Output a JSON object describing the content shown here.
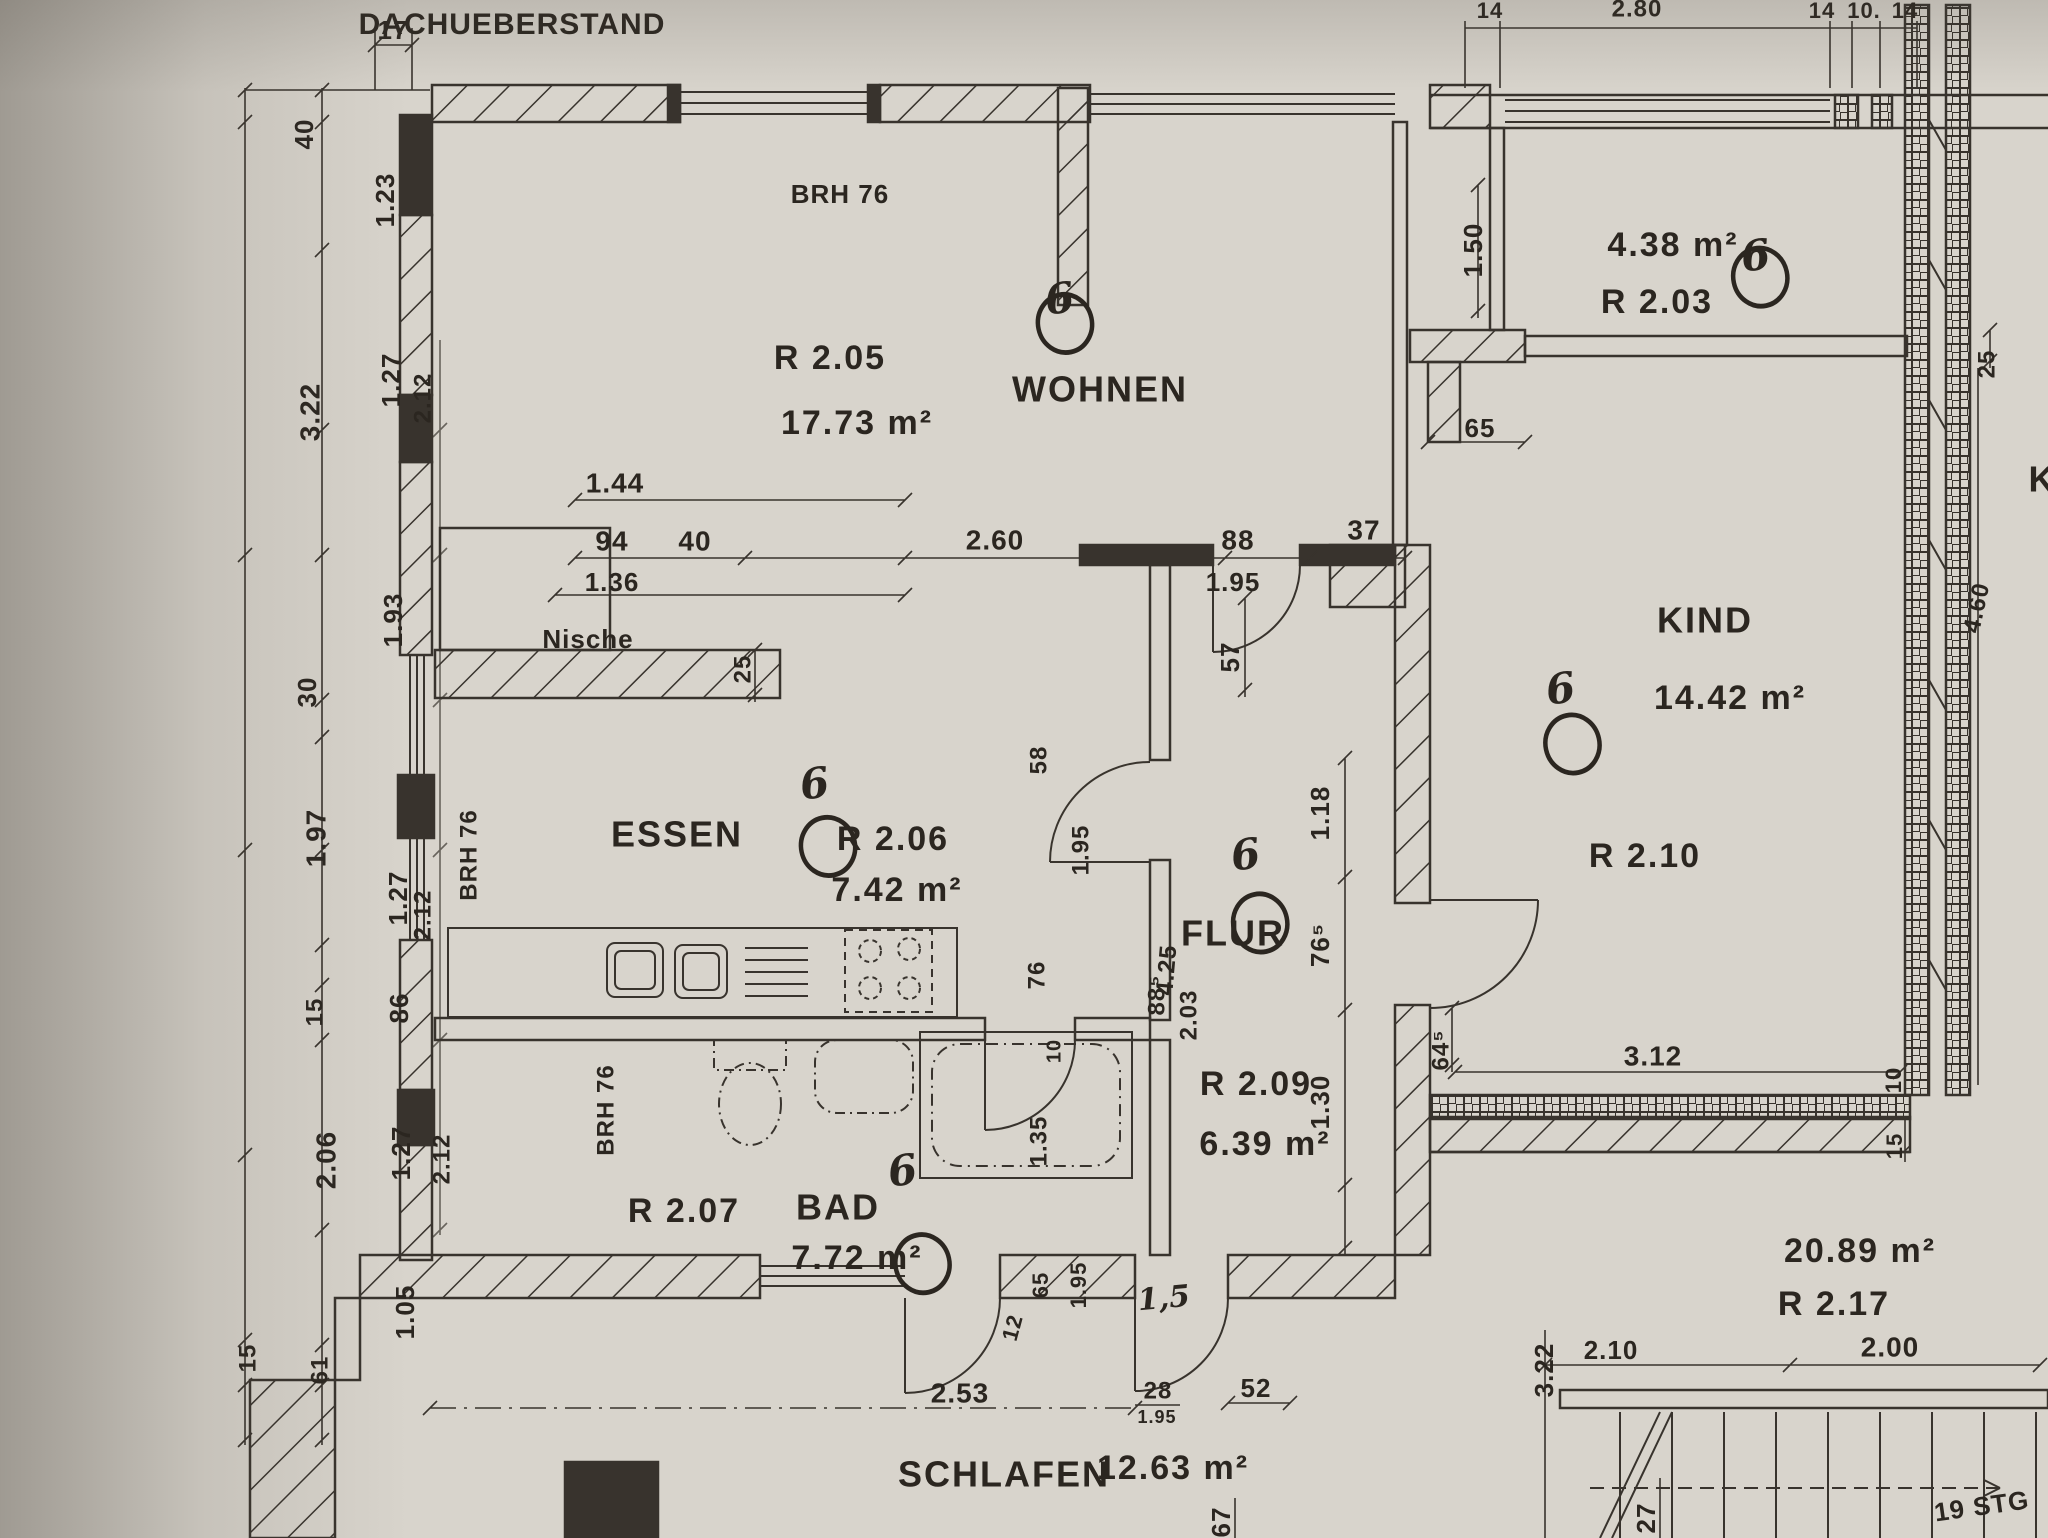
{
  "drawing": {
    "type": "architectural floor plan (photocopy/photo)",
    "note_top": "DACHUEBERSTAND",
    "room_mark_glyph": "6",
    "stair_label": "19 STG"
  },
  "colors": {
    "paper": "#d8d4cc",
    "ink": "#2b2620",
    "shadow": "#4a443c"
  },
  "rooms": [
    {
      "name": "WOHNEN",
      "number": "R 2.05",
      "area": "17.73 m²",
      "nx": 1100,
      "ny": 392,
      "ux": 830,
      "uy": 360,
      "ax": 857,
      "ay": 425,
      "mx": 1060,
      "my": 300
    },
    {
      "name": "ESSEN",
      "number": "R 2.06",
      "area": "7.42 m²",
      "nx": 677,
      "ny": 837,
      "ux": 893,
      "uy": 841,
      "ax": 897,
      "ay": 892,
      "mx": 815,
      "my": 785
    },
    {
      "name": "BAD",
      "number": "R 2.07",
      "area": "7.72 m²",
      "nx": 838,
      "ny": 1210,
      "ux": 684,
      "uy": 1213,
      "ax": 857,
      "ay": 1260,
      "mx": 903,
      "my": 1172
    },
    {
      "name": "FLUR",
      "number": "R 2.09",
      "area": "6.39 m²",
      "nx": 1233,
      "ny": 936,
      "ux": 1256,
      "uy": 1086,
      "ax": 1265,
      "ay": 1146,
      "mx": 1246,
      "my": 856
    },
    {
      "name": "KIND",
      "number": "R 2.10",
      "area": "14.42 m²",
      "nx": 1705,
      "ny": 623,
      "ux": 1645,
      "uy": 858,
      "ax": 1730,
      "ay": 700,
      "mx": 1561,
      "my": 690
    },
    {
      "name": "",
      "number": "R 2.03",
      "area": "4.38 m²",
      "ux": 1657,
      "uy": 304,
      "ax": 1673,
      "ay": 247,
      "mx": 1756,
      "my": 257
    },
    {
      "name": "SCHLAFEN",
      "number": "",
      "area": "12.63 m²",
      "nx": 1004,
      "ny": 1477,
      "ax": 1173,
      "ay": 1470
    },
    {
      "name": "",
      "number": "R 2.17",
      "area": "20.89 m²",
      "ux": 1834,
      "uy": 1306,
      "ax": 1860,
      "ay": 1253
    }
  ],
  "labels": [
    {
      "t": "17",
      "x": 393,
      "y": 32,
      "r": 0,
      "s": 26,
      "k": "d"
    },
    {
      "t": "DACHUEBERSTAND",
      "x": 512,
      "y": 26,
      "r": 0,
      "s": 30,
      "k": "d"
    },
    {
      "t": "BRH 76",
      "x": 840,
      "y": 196,
      "r": 0,
      "s": 26,
      "k": "d"
    },
    {
      "t": "1.44",
      "x": 615,
      "y": 485,
      "r": 0,
      "s": 28,
      "k": "d"
    },
    {
      "t": "94",
      "x": 612,
      "y": 543,
      "r": 0,
      "s": 28,
      "k": "d"
    },
    {
      "t": "40",
      "x": 695,
      "y": 543,
      "r": 0,
      "s": 28,
      "k": "d"
    },
    {
      "t": "1.36",
      "x": 612,
      "y": 584,
      "r": 0,
      "s": 26,
      "k": "d"
    },
    {
      "t": "2.60",
      "x": 995,
      "y": 542,
      "r": 0,
      "s": 28,
      "k": "d"
    },
    {
      "t": "88",
      "x": 1238,
      "y": 542,
      "r": 0,
      "s": 28,
      "k": "d"
    },
    {
      "t": "37",
      "x": 1364,
      "y": 532,
      "r": 0,
      "s": 28,
      "k": "d"
    },
    {
      "t": "1.95",
      "x": 1233,
      "y": 584,
      "r": 0,
      "s": 26,
      "k": "d"
    },
    {
      "t": "57",
      "x": 1232,
      "y": 657,
      "r": -90,
      "s": 26,
      "k": "d"
    },
    {
      "t": "25",
      "x": 744,
      "y": 669,
      "r": -90,
      "s": 24,
      "k": "d"
    },
    {
      "t": "Nische",
      "x": 588,
      "y": 641,
      "r": 0,
      "s": 26,
      "k": "d"
    },
    {
      "t": "40",
      "x": 306,
      "y": 134,
      "r": -90,
      "s": 26,
      "k": "d"
    },
    {
      "t": "1.23",
      "x": 387,
      "y": 200,
      "r": -90,
      "s": 26,
      "k": "d"
    },
    {
      "t": "3.22",
      "x": 312,
      "y": 412,
      "r": -90,
      "s": 28,
      "k": "d"
    },
    {
      "t": "1.27",
      "x": 393,
      "y": 380,
      "r": -90,
      "s": 26,
      "k": "d"
    },
    {
      "t": "2.12",
      "x": 424,
      "y": 398,
      "r": -90,
      "s": 24,
      "k": "d"
    },
    {
      "t": "1.93",
      "x": 395,
      "y": 620,
      "r": -90,
      "s": 26,
      "k": "d"
    },
    {
      "t": "30",
      "x": 309,
      "y": 692,
      "r": -90,
      "s": 26,
      "k": "d"
    },
    {
      "t": "1.97",
      "x": 318,
      "y": 838,
      "r": -90,
      "s": 28,
      "k": "d"
    },
    {
      "t": "1.27",
      "x": 400,
      "y": 898,
      "r": -90,
      "s": 26,
      "k": "d"
    },
    {
      "t": "2.12",
      "x": 424,
      "y": 915,
      "r": -90,
      "s": 24,
      "k": "d"
    },
    {
      "t": "15",
      "x": 316,
      "y": 1012,
      "r": -90,
      "s": 24,
      "k": "d"
    },
    {
      "t": "86",
      "x": 401,
      "y": 1008,
      "r": -90,
      "s": 26,
      "k": "d"
    },
    {
      "t": "2.06",
      "x": 328,
      "y": 1160,
      "r": -90,
      "s": 28,
      "k": "d"
    },
    {
      "t": "1.27",
      "x": 403,
      "y": 1153,
      "r": -90,
      "s": 26,
      "k": "d"
    },
    {
      "t": "2.12",
      "x": 443,
      "y": 1159,
      "r": -90,
      "s": 24,
      "k": "d"
    },
    {
      "t": "1.05",
      "x": 407,
      "y": 1312,
      "r": -90,
      "s": 26,
      "k": "d"
    },
    {
      "t": "15",
      "x": 249,
      "y": 1358,
      "r": -90,
      "s": 24,
      "k": "d"
    },
    {
      "t": "61",
      "x": 321,
      "y": 1370,
      "r": -90,
      "s": 24,
      "k": "d"
    },
    {
      "t": "14",
      "x": 1490,
      "y": 12,
      "r": 0,
      "s": 22,
      "k": "d"
    },
    {
      "t": "2.80",
      "x": 1637,
      "y": 10,
      "r": 0,
      "s": 24,
      "k": "d"
    },
    {
      "t": "14",
      "x": 1822,
      "y": 12,
      "r": 0,
      "s": 22,
      "k": "d"
    },
    {
      "t": "10.",
      "x": 1864,
      "y": 12,
      "r": 0,
      "s": 22,
      "k": "d"
    },
    {
      "t": "14",
      "x": 1905,
      "y": 12,
      "r": 0,
      "s": 22,
      "k": "d"
    },
    {
      "t": "1.50",
      "x": 1475,
      "y": 250,
      "r": -90,
      "s": 26,
      "k": "d"
    },
    {
      "t": "65",
      "x": 1480,
      "y": 430,
      "r": 0,
      "s": 26,
      "k": "d"
    },
    {
      "t": "25",
      "x": 1988,
      "y": 364,
      "r": -90,
      "s": 24,
      "k": "d"
    },
    {
      "t": "4.60",
      "x": 1978,
      "y": 608,
      "r": -78,
      "s": 24,
      "k": "d"
    },
    {
      "t": "1.18",
      "x": 1322,
      "y": 813,
      "r": -90,
      "s": 26,
      "k": "d"
    },
    {
      "t": "76⁵",
      "x": 1322,
      "y": 945,
      "r": -90,
      "s": 26,
      "k": "d"
    },
    {
      "t": "1.30",
      "x": 1322,
      "y": 1102,
      "r": -90,
      "s": 26,
      "k": "d"
    },
    {
      "t": "4.25",
      "x": 1168,
      "y": 970,
      "r": -85,
      "s": 24,
      "k": "d"
    },
    {
      "t": "64⁵",
      "x": 1442,
      "y": 1050,
      "r": -90,
      "s": 24,
      "k": "d"
    },
    {
      "t": "3.12",
      "x": 1653,
      "y": 1058,
      "r": 0,
      "s": 28,
      "k": "d"
    },
    {
      "t": "10",
      "x": 1895,
      "y": 1080,
      "r": -90,
      "s": 22,
      "k": "d"
    },
    {
      "t": "15",
      "x": 1896,
      "y": 1146,
      "r": -90,
      "s": 22,
      "k": "d"
    },
    {
      "t": "58",
      "x": 1040,
      "y": 760,
      "r": -90,
      "s": 24,
      "k": "d"
    },
    {
      "t": "1.95",
      "x": 1082,
      "y": 850,
      "r": -90,
      "s": 24,
      "k": "d"
    },
    {
      "t": "76",
      "x": 1038,
      "y": 975,
      "r": -90,
      "s": 24,
      "k": "d"
    },
    {
      "t": "10",
      "x": 1055,
      "y": 1051,
      "r": -90,
      "s": 20,
      "k": "d"
    },
    {
      "t": "1.35",
      "x": 1040,
      "y": 1141,
      "r": -90,
      "s": 24,
      "k": "d"
    },
    {
      "t": "65",
      "x": 1042,
      "y": 1285,
      "r": -90,
      "s": 22,
      "k": "d"
    },
    {
      "t": "1.95",
      "x": 1080,
      "y": 1285,
      "r": -90,
      "s": 22,
      "k": "d"
    },
    {
      "t": "12",
      "x": 1014,
      "y": 1328,
      "r": -75,
      "s": 22,
      "k": "d"
    },
    {
      "t": "88⁵",
      "x": 1158,
      "y": 995,
      "r": -90,
      "s": 24,
      "k": "d"
    },
    {
      "t": "2.03",
      "x": 1190,
      "y": 1015,
      "r": -90,
      "s": 24,
      "k": "d"
    },
    {
      "t": "BRH 76",
      "x": 470,
      "y": 855,
      "r": -90,
      "s": 24,
      "k": "d"
    },
    {
      "t": "BRH 76",
      "x": 607,
      "y": 1110,
      "r": -90,
      "s": 24,
      "k": "d"
    },
    {
      "t": "2.53",
      "x": 960,
      "y": 1395,
      "r": 0,
      "s": 28,
      "k": "d"
    },
    {
      "t": "28",
      "x": 1158,
      "y": 1392,
      "r": 0,
      "s": 24,
      "k": "d"
    },
    {
      "t": "1.95",
      "x": 1157,
      "y": 1418,
      "r": 0,
      "s": 18,
      "k": "d"
    },
    {
      "t": "52",
      "x": 1256,
      "y": 1390,
      "r": 0,
      "s": 26,
      "k": "d"
    },
    {
      "t": "67",
      "x": 1223,
      "y": 1522,
      "r": -90,
      "s": 26,
      "k": "d"
    },
    {
      "t": "2.10",
      "x": 1611,
      "y": 1352,
      "r": 0,
      "s": 26,
      "k": "d"
    },
    {
      "t": "2.00",
      "x": 1890,
      "y": 1349,
      "r": 0,
      "s": 28,
      "k": "d"
    },
    {
      "t": "3.22",
      "x": 1546,
      "y": 1370,
      "r": -90,
      "s": 26,
      "k": "d"
    },
    {
      "t": "27",
      "x": 1648,
      "y": 1518,
      "r": -90,
      "s": 26,
      "k": "d"
    },
    {
      "t": "19 STG",
      "x": 1982,
      "y": 1508,
      "r": -8,
      "s": 26,
      "k": "d"
    },
    {
      "t": "K",
      "x": 2042,
      "y": 482,
      "r": 0,
      "s": 36,
      "k": "d"
    },
    {
      "t": "1,5",
      "x": 1164,
      "y": 1300,
      "r": -5,
      "s": 30,
      "k": "h"
    }
  ]
}
